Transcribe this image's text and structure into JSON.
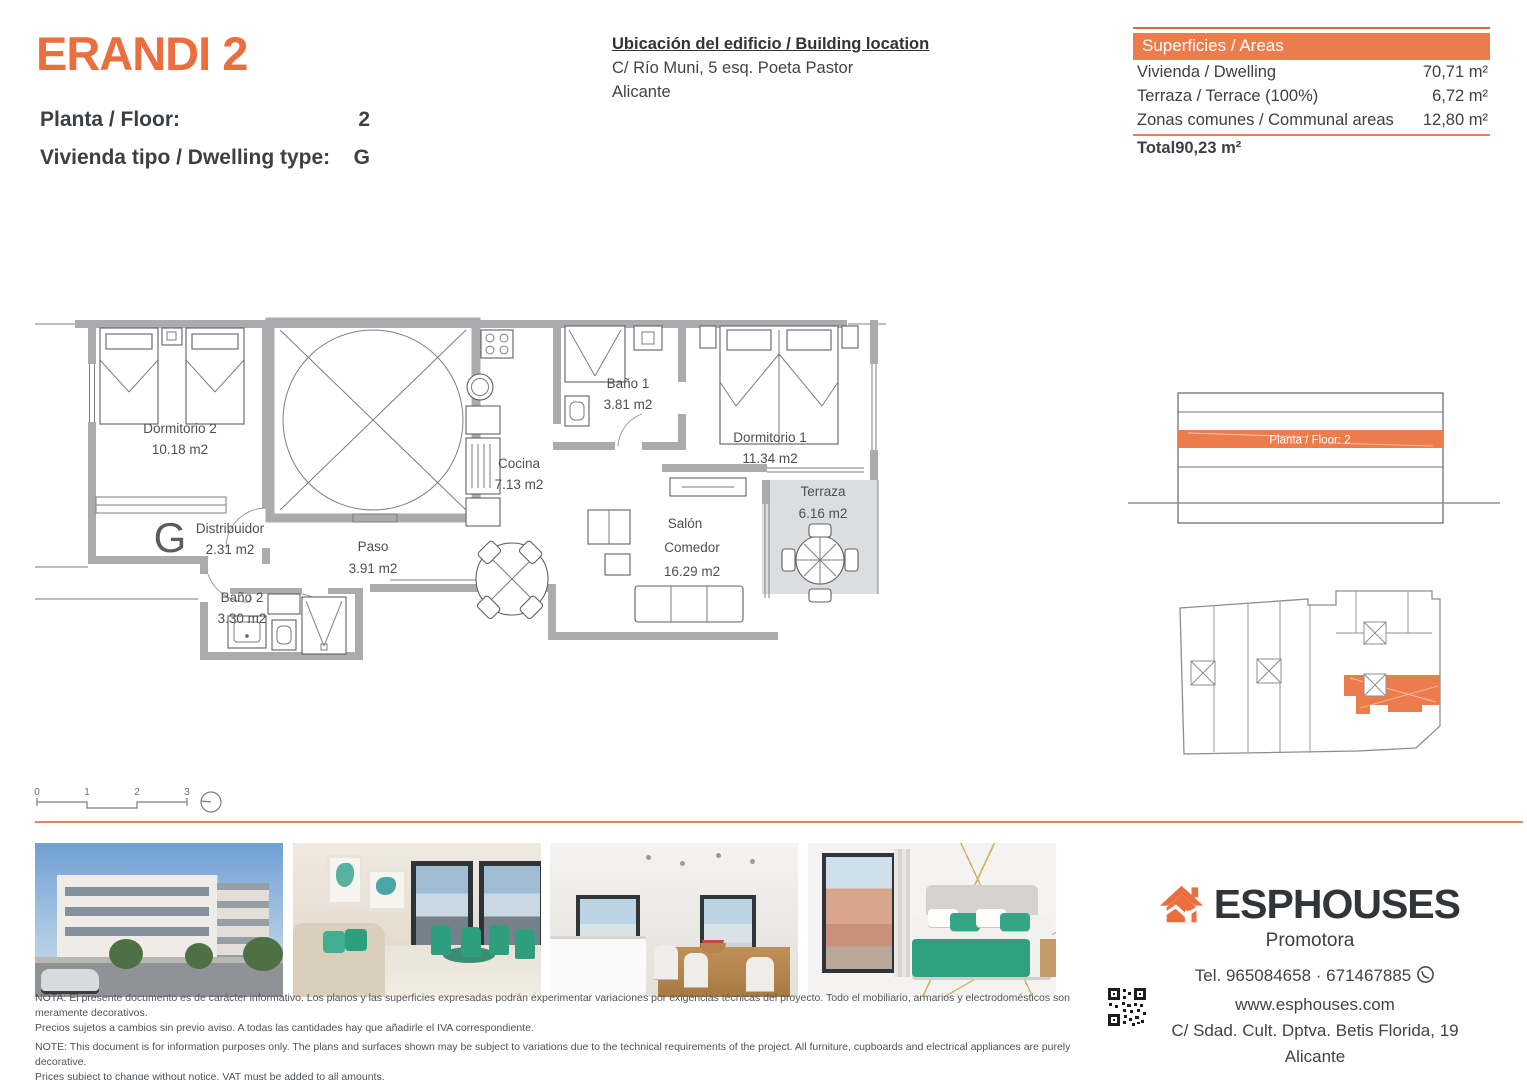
{
  "header": {
    "title": "ERANDI 2",
    "floor_label": "Planta / Floor:",
    "floor_value": "2",
    "type_label": "Vivienda tipo / Dwelling type:",
    "type_value": "G",
    "location_title": "Ubicación del edificio / Building location",
    "location_line1": "C/ Río Muni, 5 esq. Poeta Pastor",
    "location_line2": "Alicante"
  },
  "areas_table": {
    "header": "Superficies / Areas",
    "rows": [
      {
        "label": "Vivienda / Dwelling",
        "value": "70,71 m²"
      },
      {
        "label": "Terraza / Terrace (100%)",
        "value": "6,72 m²"
      },
      {
        "label": "Zonas comunes / Communal areas",
        "value": "12,80 m²"
      }
    ],
    "total_label": "Total",
    "total_value": "90,23 m²"
  },
  "floor_plan": {
    "type_letter": "G",
    "rooms": {
      "dorm2": {
        "name": "Dormitorio 2",
        "area": "10.18 m2"
      },
      "distribuidor": {
        "name": "Distribuidor",
        "area": "2.31 m2"
      },
      "bano2": {
        "name": "Baño 2",
        "area": "3.30 m2"
      },
      "paso": {
        "name": "Paso",
        "area": "3.91 m2"
      },
      "cocina": {
        "name": "Cocina",
        "area": "7.13 m2"
      },
      "bano1": {
        "name": "Baño 1",
        "area": "3.81 m2"
      },
      "dorm1": {
        "name": "Dormitorio 1",
        "area": "11.34 m2"
      },
      "salon": {
        "name_line1": "Salón",
        "name_line2": "Comedor",
        "area": "16.29 m2"
      },
      "terraza": {
        "name": "Terraza",
        "area": "6.16 m2"
      }
    },
    "scale_ticks": [
      "0",
      "1",
      "2",
      "3"
    ]
  },
  "elevation": {
    "highlight_label": "Planta / Floor: 2"
  },
  "footer": {
    "brand": "ESPHOUSES",
    "brand_sub": "Promotora",
    "phone": "Tel. 965084658 · 671467885",
    "website": "www.esphouses.com",
    "address": "C/ Sdad. Cult. Dptva. Betis Florida, 19",
    "city": "Alicante",
    "notes": [
      "NOTA: El presente documento es de carácter informativo. Los planos y las superficies expresadas podrán experimentar variaciones por exigencias técnicas del proyecto. Todo el mobiliario, armarios y electrodomésticos son meramente decorativos.",
      "Precios sujetos a cambios sin previo aviso. A todas las cantidades hay que añadirle el IVA correspondiente.",
      "NOTE: This document is for information purposes only. The plans and surfaces shown may be subject to variations due to the technical requirements of the project. All furniture, cupboards and electrical appliances are purely decorative.",
      "Prices subject to change without notice. VAT must be added to all amounts."
    ]
  },
  "colors": {
    "accent": "#eb6e3e",
    "table_header": "#ed7c4d",
    "wall_grey": "#a9abad",
    "terrace_grey": "#dcddde"
  }
}
